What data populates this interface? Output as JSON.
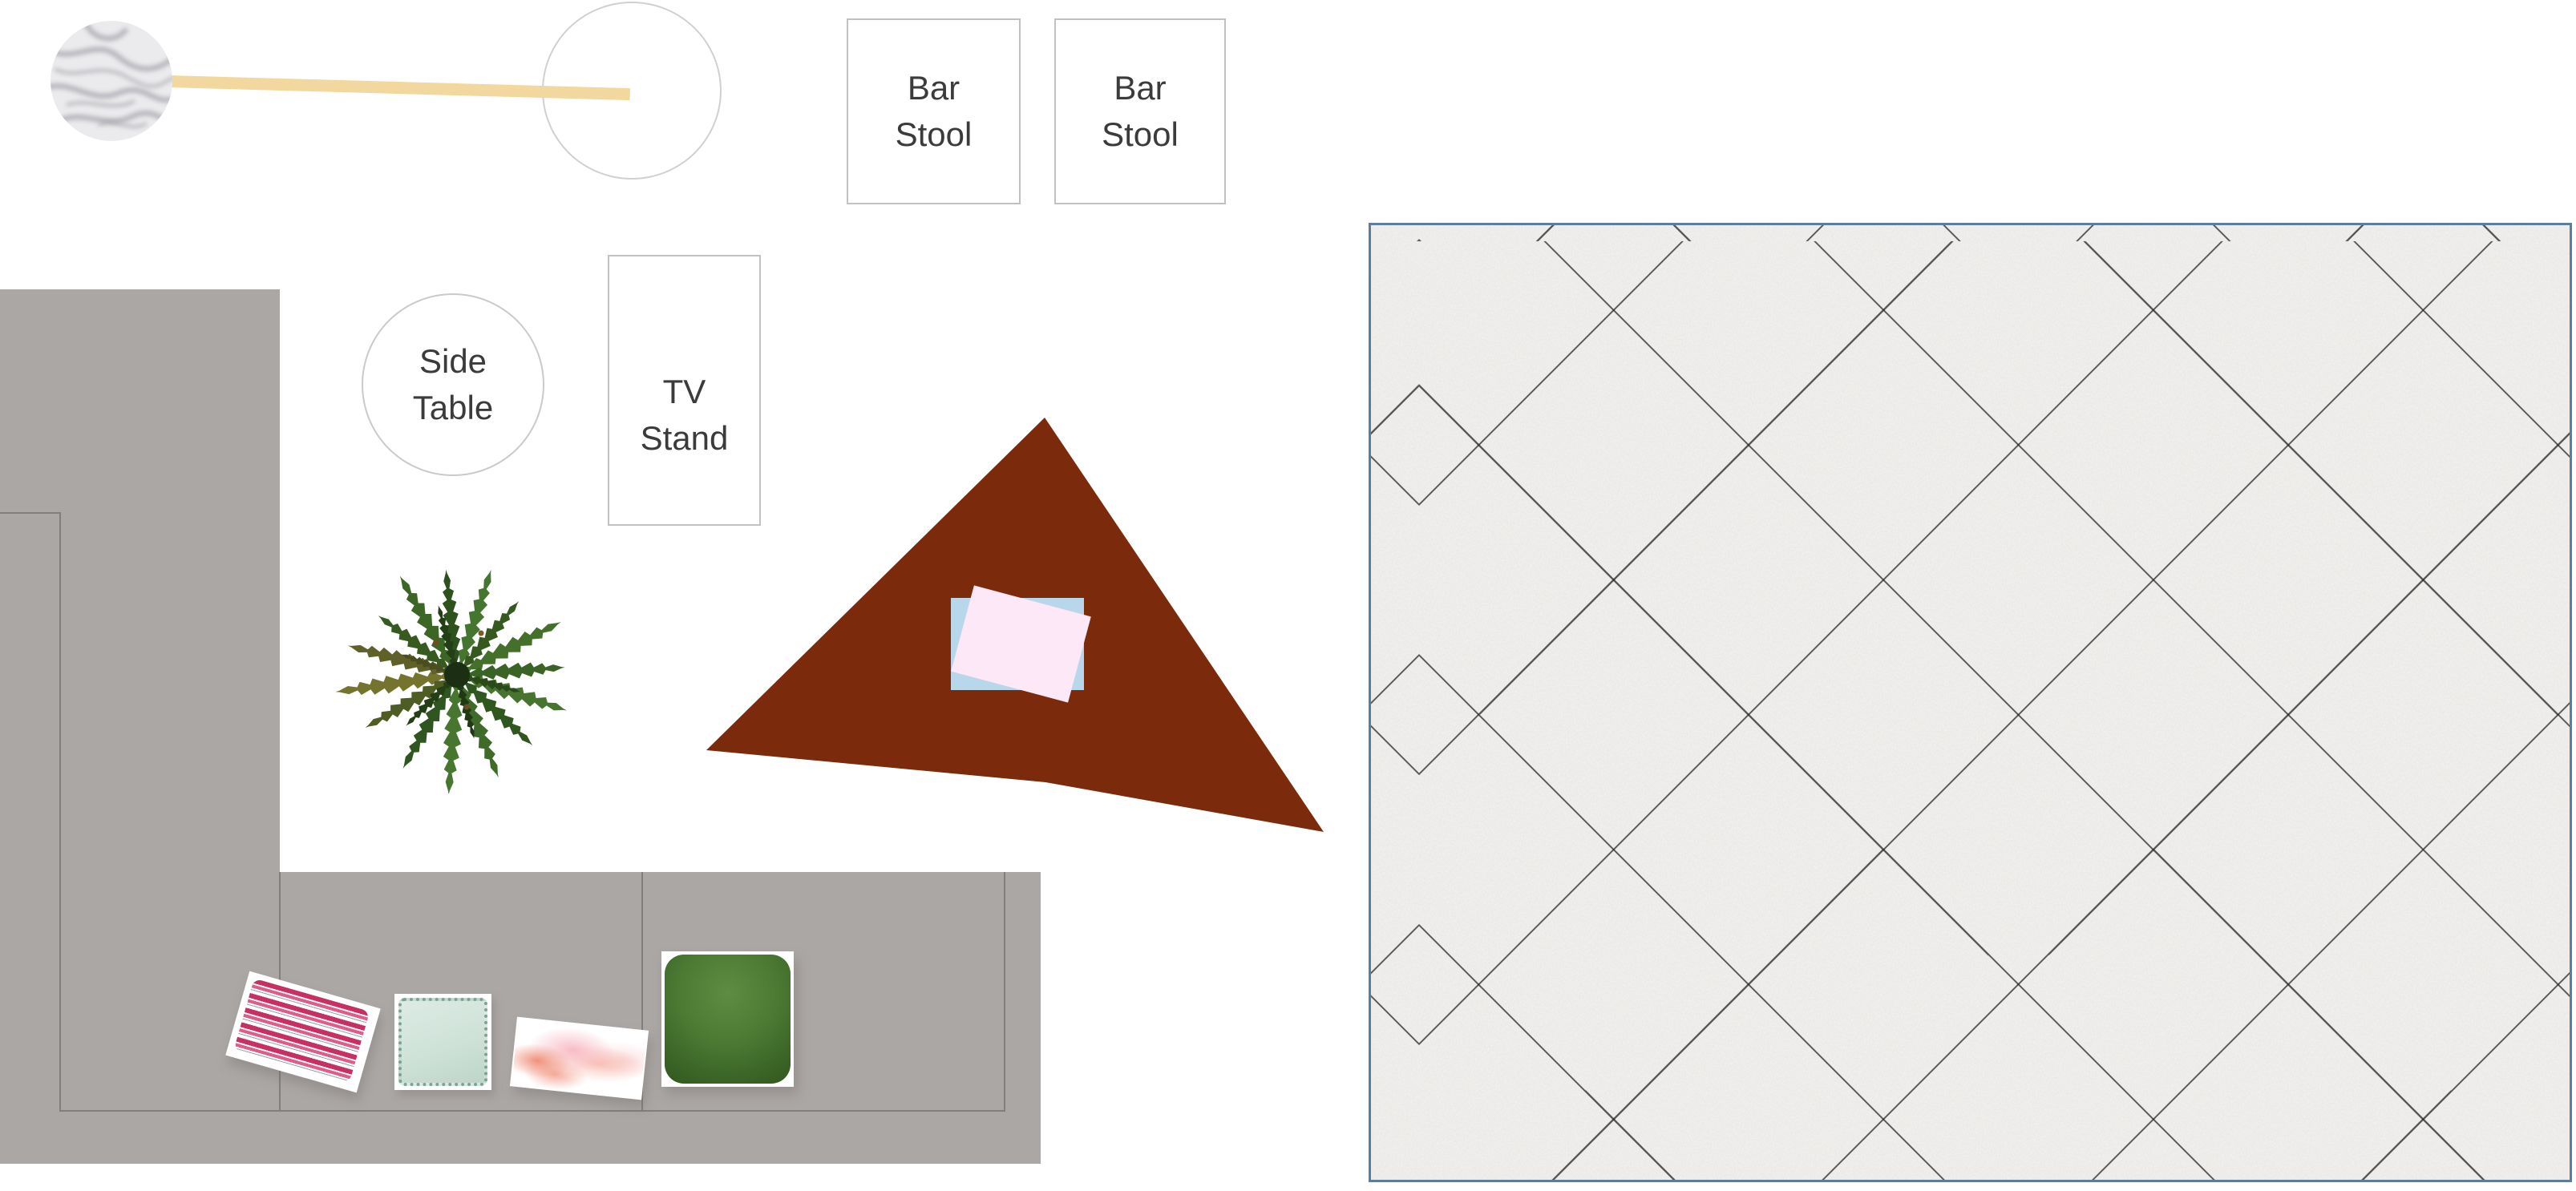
{
  "labels": {
    "bar_stool_1": {
      "line1": "Bar",
      "line2": "Stool"
    },
    "bar_stool_2": {
      "line1": "Bar",
      "line2": "Stool"
    },
    "side_table": {
      "line1": "Side",
      "line2": "Table"
    },
    "tv_stand": {
      "line1": "TV",
      "line2": "Stand"
    }
  },
  "colors": {
    "label_text": "#3b3b3b",
    "sofa_gray": "#aba7a5",
    "sofa_seam": "#827e7b",
    "rug_brown": "#7b2b0b",
    "paper_blue": "#b9d7ea",
    "paper_pink": "#fce8f7",
    "bar_tan": "#f2d79e",
    "tile_border": "#5b7e9c",
    "tile_base": "#f4f3f1",
    "pillow_stripe_pink": "#c73060",
    "pillow_mint": "#cfe2d8",
    "pillow_green": "#33571e",
    "plant_green": "#3c6625",
    "marble_vein": "#a3a3ab"
  }
}
